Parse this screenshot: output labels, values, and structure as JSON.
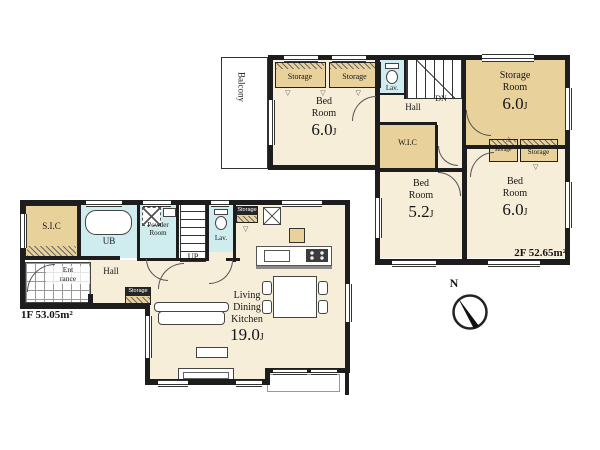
{
  "colors": {
    "wall": "#1d1d1d",
    "room": "#f7eeda",
    "storage": "#e8d19b",
    "wet": "#cfecee"
  },
  "floor2": {
    "area_label": "2F 52.65m²",
    "balcony": "Balcony",
    "closet_left": "Storage",
    "closet_right": "Storage",
    "lav": "Lav.",
    "hall": "Hall",
    "stairs": "DN",
    "bedroom1": {
      "name1": "Bed",
      "name2": "Room",
      "size": "6.0",
      "unit": "J"
    },
    "storage_room": {
      "name1": "Storage",
      "name2": "Room",
      "size": "6.0",
      "unit": "J"
    },
    "wic": "W.I.C",
    "bedroom2": {
      "name1": "Bed",
      "name2": "Room",
      "size": "5.2",
      "unit": "J"
    },
    "bedroom3": {
      "name1": "Bed",
      "name2": "Room",
      "size": "6.0",
      "unit": "J"
    },
    "closet_small": "Storage",
    "closet_b3": "Storage"
  },
  "floor1": {
    "area_label": "1F 53.05m²",
    "sic": "S.I.C",
    "ub": "UB",
    "powder": {
      "name1": "Powder",
      "name2": "Room"
    },
    "lav": "Lav.",
    "stairs": "UP",
    "entrance": {
      "name1": "Ent",
      "name2": "rance"
    },
    "hall": "Hall",
    "closet_hall": "Storage",
    "closet_kitchen": "Storage",
    "ldk": {
      "name1": "Living",
      "name2": "Dining",
      "name3": "Kitchen",
      "size": "19.0",
      "unit": "J"
    }
  },
  "compass": {
    "north": "N"
  },
  "glyphs": {
    "closet_marks": "▽ ▽ ▽",
    "closet_mark": "▽",
    "closet_mark_up": "△"
  }
}
